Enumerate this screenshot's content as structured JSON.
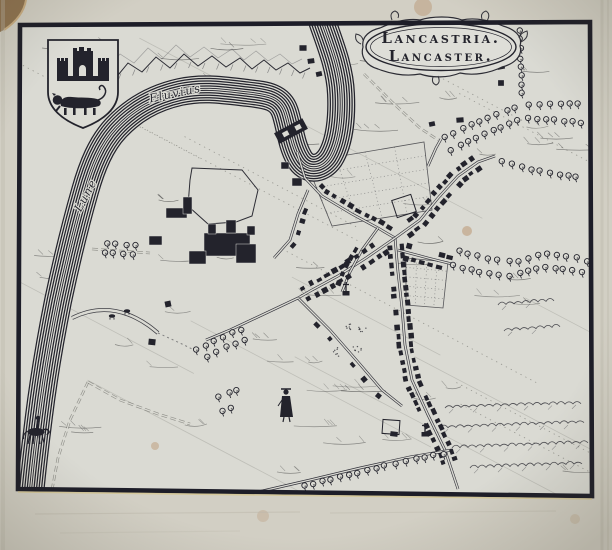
{
  "map": {
    "title_line1": "Lancastria.",
    "title_line2": "Lancaster.",
    "river_label_fluvius": "Fluvius",
    "river_label_lune": "Lune"
  },
  "palette": {
    "margin_paper": "#d2cfc4",
    "map_paper": "#dadad3",
    "cartouche_paper": "#deded8",
    "shield_paper": "#dcdcd5",
    "ink": "#23232c",
    "ink_soft": "#34343b",
    "ink_faint": "#6f6f68",
    "foxing": "#a8703d"
  },
  "features": {
    "frame_quad": [
      [
        20,
        25
      ],
      [
        590,
        22
      ],
      [
        592,
        496
      ],
      [
        18,
        489
      ]
    ],
    "river": {
      "width": 28,
      "path": "M321,18 C330,44 340,68 341,94 C342,116 340,142 330,158 C321,171 306,171 299,158 C291,144 290,127 285,112 C280,97 267,95 248,93 C222,90 203,87 180,92 C153,98 133,110 116,128 C101,144 92,166 85,191 C75,226 66,263 58,301 C51,336 44,376 39,416 C35,448 32,471 30,496"
    },
    "mountains": [
      [
        114,
        80
      ],
      [
        128,
        63
      ],
      [
        142,
        72
      ],
      [
        156,
        57
      ],
      [
        170,
        68
      ],
      [
        184,
        54
      ],
      [
        198,
        66
      ],
      [
        212,
        56
      ],
      [
        226,
        67
      ],
      [
        240,
        58
      ],
      [
        252,
        69
      ],
      [
        264,
        60
      ],
      [
        276,
        70
      ],
      [
        288,
        63
      ],
      [
        300,
        73
      ],
      [
        310,
        68
      ]
    ],
    "streets": [
      {
        "id": "bridge-street",
        "pts": [
          [
            297,
            152
          ],
          [
            305,
            178
          ],
          [
            322,
            196
          ],
          [
            352,
            214
          ],
          [
            378,
            228
          ],
          [
            395,
            238
          ]
        ],
        "houses": {
          "range": [
            0.3,
            1
          ],
          "sides": [
            -1
          ],
          "spacing": 8.5
        }
      },
      {
        "id": "northeast-street",
        "pts": [
          [
            395,
            238
          ],
          [
            420,
            220
          ],
          [
            438,
            198
          ],
          [
            458,
            176
          ],
          [
            478,
            162
          ],
          [
            495,
            156
          ]
        ],
        "houses": {
          "range": [
            0.08,
            0.85
          ],
          "sides": [
            -1,
            1
          ],
          "spacing": 8.5
        }
      },
      {
        "id": "main-south-street",
        "pts": [
          [
            395,
            238
          ],
          [
            398,
            272
          ],
          [
            402,
            308
          ],
          [
            405,
            345
          ],
          [
            412,
            380
          ],
          [
            428,
            415
          ],
          [
            445,
            450
          ],
          [
            458,
            489
          ]
        ],
        "houses": {
          "range": [
            0.02,
            0.9
          ],
          "sides": [
            -1,
            1
          ],
          "spacing": 8.5
        }
      },
      {
        "id": "southwest-street",
        "pts": [
          [
            395,
            238
          ],
          [
            366,
            258
          ],
          [
            338,
            276
          ],
          [
            312,
            290
          ],
          [
            298,
            298
          ]
        ],
        "houses": {
          "range": [
            0.1,
            1
          ],
          "sides": [
            -1,
            1
          ],
          "spacing": 8.5
        }
      },
      {
        "id": "middle-lane",
        "pts": [
          [
            298,
            298
          ],
          [
            330,
            330
          ],
          [
            358,
            362
          ],
          [
            382,
            390
          ],
          [
            402,
            406
          ]
        ],
        "houses": {
          "range": [
            0.15,
            0.9
          ],
          "sides": [
            1
          ],
          "spacing": 20
        }
      },
      {
        "id": "church-lane",
        "pts": [
          [
            378,
            228
          ],
          [
            362,
            250
          ],
          [
            350,
            272
          ],
          [
            342,
            292
          ]
        ],
        "houses": {
          "range": [
            0.35,
            1
          ],
          "sides": [
            1
          ],
          "spacing": 9
        }
      },
      {
        "id": "east-street",
        "pts": [
          [
            398,
            250
          ],
          [
            428,
            258
          ],
          [
            452,
            264
          ]
        ],
        "houses": {
          "range": [
            0.1,
            0.95
          ],
          "sides": [
            -1,
            1
          ],
          "spacing": 8.5
        }
      },
      {
        "id": "castle-street",
        "pts": [
          [
            308,
            190
          ],
          [
            298,
            214
          ],
          [
            290,
            240
          ],
          [
            274,
            258
          ]
        ],
        "houses": {
          "range": [
            0.2,
            0.9
          ],
          "sides": [
            -1
          ],
          "spacing": 11
        }
      },
      {
        "id": "west-road",
        "pts": [
          [
            298,
            298
          ],
          [
            262,
            315
          ],
          [
            230,
            330
          ],
          [
            206,
            340
          ]
        ]
      },
      {
        "id": "northeast-lane-road",
        "pts": [
          [
            428,
            166
          ],
          [
            436,
            148
          ],
          [
            441,
            139
          ]
        ]
      },
      {
        "id": "bottom-lane-road",
        "pts": [
          [
            258,
            492
          ],
          [
            310,
            480
          ],
          [
            360,
            468
          ],
          [
            410,
            457
          ],
          [
            452,
            450
          ]
        ]
      },
      {
        "id": "cartouche-road",
        "pts": [
          [
            364,
            74
          ],
          [
            392,
            102
          ],
          [
            420,
            128
          ],
          [
            438,
            140
          ]
        ],
        "faint": true
      },
      {
        "id": "river-road-west",
        "pts": [
          [
            92,
            249
          ],
          [
            120,
            251
          ],
          [
            150,
            253
          ]
        ],
        "faint": true
      },
      {
        "id": "meadow-road-a",
        "pts": [
          [
            88,
            382
          ],
          [
            70,
            420
          ],
          [
            58,
            458
          ],
          [
            52,
            490
          ]
        ],
        "faint": true
      },
      {
        "id": "meadow-road-b",
        "pts": [
          [
            88,
            382
          ],
          [
            120,
            400
          ],
          [
            158,
            414
          ],
          [
            190,
            424
          ]
        ],
        "faint": true
      }
    ],
    "tree_lanes": [
      [
        [
          520,
          26
        ],
        [
          522,
          100
        ]
      ],
      [
        [
          524,
          104
        ],
        [
          586,
          104
        ]
      ],
      [
        [
          524,
          118
        ],
        [
          556,
          120
        ],
        [
          586,
          123
        ]
      ],
      [
        [
          441,
          139
        ],
        [
          466,
          127
        ],
        [
          492,
          116
        ],
        [
          519,
          106
        ]
      ],
      [
        [
          446,
          152
        ],
        [
          472,
          140
        ],
        [
          498,
          128
        ],
        [
          522,
          118
        ]
      ],
      [
        [
          497,
          160
        ],
        [
          526,
          168
        ],
        [
          556,
          174
        ],
        [
          584,
          178
        ]
      ],
      [
        [
          455,
          250
        ],
        [
          488,
          258
        ],
        [
          518,
          262
        ],
        [
          546,
          253
        ],
        [
          574,
          257
        ],
        [
          590,
          262
        ]
      ],
      [
        [
          448,
          264
        ],
        [
          480,
          272
        ],
        [
          512,
          276
        ],
        [
          542,
          267
        ],
        [
          572,
          270
        ],
        [
          588,
          274
        ]
      ],
      [
        [
          245,
          328
        ],
        [
          220,
          338
        ],
        [
          196,
          350
        ]
      ],
      [
        [
          249,
          338
        ],
        [
          224,
          348
        ],
        [
          200,
          360
        ]
      ],
      [
        [
          214,
          398
        ],
        [
          242,
          388
        ]
      ],
      [
        [
          218,
          412
        ],
        [
          236,
          406
        ]
      ],
      [
        [
          300,
          487
        ],
        [
          340,
          477
        ],
        [
          380,
          467
        ],
        [
          420,
          458
        ],
        [
          452,
          452
        ]
      ],
      [
        [
          102,
          243
        ],
        [
          138,
          245
        ]
      ],
      [
        [
          100,
          252
        ],
        [
          138,
          254
        ]
      ]
    ],
    "hedges": [
      [
        [
          445,
          408
        ],
        [
          520,
          405
        ],
        [
          588,
          403
        ]
      ],
      [
        [
          440,
          428
        ],
        [
          584,
          423
        ]
      ],
      [
        [
          452,
          448
        ],
        [
          588,
          443
        ]
      ],
      [
        [
          470,
          468
        ],
        [
          588,
          463
        ]
      ],
      [
        [
          498,
          305
        ],
        [
          560,
          300
        ]
      ],
      [
        [
          504,
          331
        ],
        [
          566,
          326
        ]
      ]
    ],
    "castle_wall": [
      [
        192,
        168
      ],
      [
        242,
        170
      ],
      [
        258,
        190
      ],
      [
        252,
        216
      ],
      [
        236,
        222
      ],
      [
        208,
        224
      ],
      [
        188,
        206
      ],
      [
        190,
        180
      ]
    ],
    "castle_blocks": [
      [
        204,
        233,
        46,
        23
      ],
      [
        189,
        251,
        17,
        13
      ],
      [
        236,
        244,
        20,
        19
      ],
      [
        166,
        208,
        21,
        10
      ],
      [
        183,
        197,
        9,
        17
      ],
      [
        149,
        236,
        13,
        9
      ],
      [
        208,
        224,
        8,
        10
      ],
      [
        226,
        220,
        10,
        13
      ],
      [
        247,
        226,
        8,
        9
      ],
      [
        292,
        178,
        10,
        8
      ],
      [
        281,
        162,
        8,
        7
      ]
    ],
    "isolated_houses": [
      [
        303,
        48
      ],
      [
        311,
        61
      ],
      [
        319,
        74
      ],
      [
        501,
        67
      ],
      [
        501,
        83
      ],
      [
        460,
        120
      ],
      [
        432,
        124
      ],
      [
        394,
        434
      ],
      [
        168,
        304
      ],
      [
        152,
        342
      ]
    ],
    "gardens": [
      [
        [
          306,
          162
        ],
        [
          424,
          142
        ],
        [
          432,
          210
        ],
        [
          332,
          226
        ]
      ],
      [
        [
          406,
          258
        ],
        [
          448,
          262
        ],
        [
          443,
          308
        ],
        [
          406,
          305
        ]
      ]
    ],
    "plant_clusters": [
      [
        348,
        326
      ],
      [
        357,
        349
      ],
      [
        337,
        352
      ],
      [
        362,
        330
      ]
    ],
    "plots": [
      [
        404,
        206,
        20,
        18,
        -18
      ],
      [
        391,
        427,
        17,
        14,
        4
      ]
    ],
    "crosses": [
      [
        346,
        291
      ],
      [
        425,
        432
      ]
    ],
    "stream": "M72,318 C96,306 118,309 136,318 C146,323 152,328 158,333",
    "stream_dots": [
      [
        158,
        333
      ],
      [
        182,
        344
      ],
      [
        198,
        352
      ]
    ],
    "cattle": [
      [
        112,
        316
      ],
      [
        127,
        311
      ]
    ]
  }
}
